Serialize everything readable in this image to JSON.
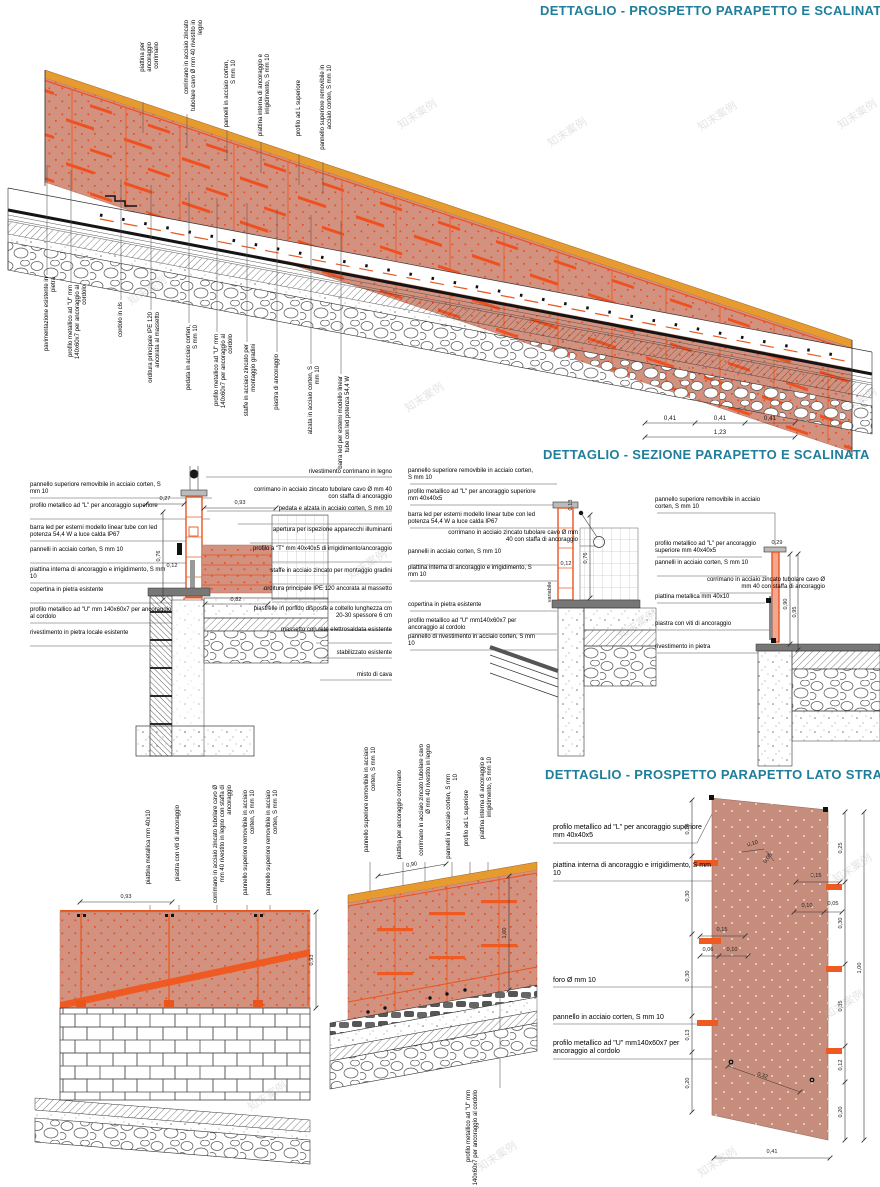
{
  "watermark": "知末案例",
  "colors": {
    "accent_teal": "#1f7e9b",
    "corten_fill": "#d3917f",
    "corten_dot": "#e84e1f",
    "orange_profile": "#ef5a23",
    "wood_band": "#e79b2e",
    "street_panel": "#c78d7c"
  },
  "titles": {
    "d1": "DETTAGLIO -  PROSPETTO PARAPETTO E SCALINATA",
    "d2": "DETTAGLIO - SEZIONE PARAPETTO E SCALINATA",
    "d3": "DETTAGLIO - PROSPETTO PARAPETTO LATO STRADA"
  },
  "d1": {
    "top_labels": [
      "piattina per ancoraggio corrimano",
      "corrimano in acciaio zincato tubolare cavo Ø mm 40 rivestito in legno",
      "pannelli in acciaio corten, S mm 10",
      "piattina interna di ancoraggio e irrigidimento, S mm 10",
      "profilo ad L superiore",
      "pannello superiore removibile in acciaio corten, S mm 10"
    ],
    "bottom_labels": [
      "pavimentazione esistente in pietra",
      "profilo metallico ad \"U\" mm 140x60x7 per ancoraggio al cordolo",
      "cordolo in cls",
      "orditura principale IPE 120 ancorata al massetto",
      "pedata in acciaio corten, S mm 10",
      "profilo metallico ad \"U\" mm 140x60x7 per ancoraggio al cordolo",
      "staffe in acciaio zincato per montaggio gradini",
      "piastra di ancoraggio",
      "alzata in acciaio corten, S mm 10",
      "barra led per esterni modello linear tube con led potenza 54,4 W"
    ],
    "dims": {
      "seg": "0,41",
      "total": "1,23"
    }
  },
  "d2": {
    "left": {
      "labels_left": [
        "pannello superiore removibile in acciaio corten, S mm 10",
        "profilo metallico ad \"L\" per ancoraggio superiore",
        "barra led per esterni modello linear tube con led potenza 54,4 W a luce calda IP67",
        "pannelli in acciaio corten, S mm 10",
        "piattina interna di ancoraggio e irrigidimento, S mm 10",
        "copertina in pietra esistente",
        "profilo metallico ad \"U\" mm 140x60x7 per ancoraggio al cordolo",
        "rivestimento in pietra locale esistente"
      ],
      "labels_right": [
        "rivestimento corrimano in legno",
        "corrimano in acciaio zincato tubolare cavo Ø mm 40 con staffa di ancoraggio",
        "pedata e alzata in acciaio corten, S mm 10",
        "apertura per ispezione apparecchi illuminanti",
        "profilo a \"T\" mm 40x40x5 di irrigidimento/ancoraggio",
        "staffe in acciaio zincato per montaggio gradini",
        "orditura principale IPE 120 ancorata al massetto",
        "piastrelle in porfido disposte a coltello lunghezza cm 20-30 spessore 6 cm",
        "massetto con rete elettrosaldata esistente",
        "stabilizzato esistente",
        "misto di cava"
      ],
      "dims": [
        "0,27",
        "0,93",
        "0,76",
        "0,12",
        "0,82"
      ]
    },
    "mid": {
      "labels": [
        "pannello superiore removibile in acciaio corten, S mm 10",
        "profilo metallico ad \"L\" per ancoraggio superiore mm 40x40x5",
        "barra led per esterni modello linear tube con led potenza 54,4 W a luce calda IP67",
        "corrimano in acciaio zincato tubolare cavo Ø mm 40 con staffa di ancoraggio",
        "pannelli in acciaio corten, S mm 10",
        "piattina interna di ancoraggio e irrigidimento, S mm 10",
        "copertina in pietra esistente",
        "profilo metallico ad \"U\" mm140x60x7 per ancoraggio al cordolo",
        "pannello di rivestimento in acciaio corten, S mm 10"
      ],
      "dims": [
        "0,13",
        "0,12",
        "variabile",
        "0,76"
      ]
    },
    "right": {
      "labels": [
        "pannello superiore removibile in acciaio corten, S mm 10",
        "profilo metallico ad \"L\" per ancoraggio superiore mm 40x40x5",
        "pannelli in acciaio corten, S mm 10",
        "corrimano in acciaio zincato tubolare cavo Ø mm 40 con staffa di ancoraggio",
        "piattina metallica mm 40x10",
        "piastra con viti di ancoraggio",
        "rivestimento in pietra"
      ],
      "dims": [
        "0,29",
        "0,90",
        "0,95"
      ]
    }
  },
  "bl": {
    "labels": [
      "piattina metallica mm 40x10",
      "piastra con viti di ancoraggio",
      "corrimano in acciaio zincato tubolare cavo Ø mm 40 rivestito in legno con staffa di ancoraggio",
      "pannello superiore removibile in acciaio corten, S mm 10",
      "pannello superiore removibile in acciaio corten, S mm 10"
    ],
    "dims": [
      "0,93",
      "0,93"
    ]
  },
  "bm": {
    "labels": [
      "pannello superiore removibile in acciaio corten, S mm 10",
      "piattina per ancoraggio corrimano",
      "corrimano in acciaio zincato tubolare cavo Ø mm 40 rivestito in legno",
      "pannelli in acciaio corten, S mm 10",
      "profilo ad L superiore",
      "piattina interna di ancoraggio e irrigidimento, S mm 10"
    ],
    "bottom_label": "profilo metallico ad \"U\" mm 140x60x7 per ancoraggio al cordolo",
    "dims": [
      "0,90",
      "1,00"
    ]
  },
  "d3": {
    "labels": [
      "profilo metallico ad \"L\" per ancoraggio superiore mm 40x40x5",
      "piattina interna di ancoraggio e irrigidimento,  S mm 10",
      "foro Ø mm 10",
      "pannello in acciaio corten, S mm 10",
      "profilo metallico ad \"U\" mm140x60x7 per ancoraggio al cordolo"
    ],
    "dims_left": [
      "0,24",
      "0,30",
      "0,30",
      "0,13",
      "0,20"
    ],
    "dims_right": [
      "0,25",
      "0,30",
      "0,35",
      "0,12",
      "0,20"
    ],
    "dim_total": "1,00",
    "dims_inner": [
      "0,10",
      "0,05",
      "0,15",
      "0,06",
      "0,10",
      "0,15",
      "0,10",
      "0,05",
      "0,32",
      "0,41"
    ]
  }
}
